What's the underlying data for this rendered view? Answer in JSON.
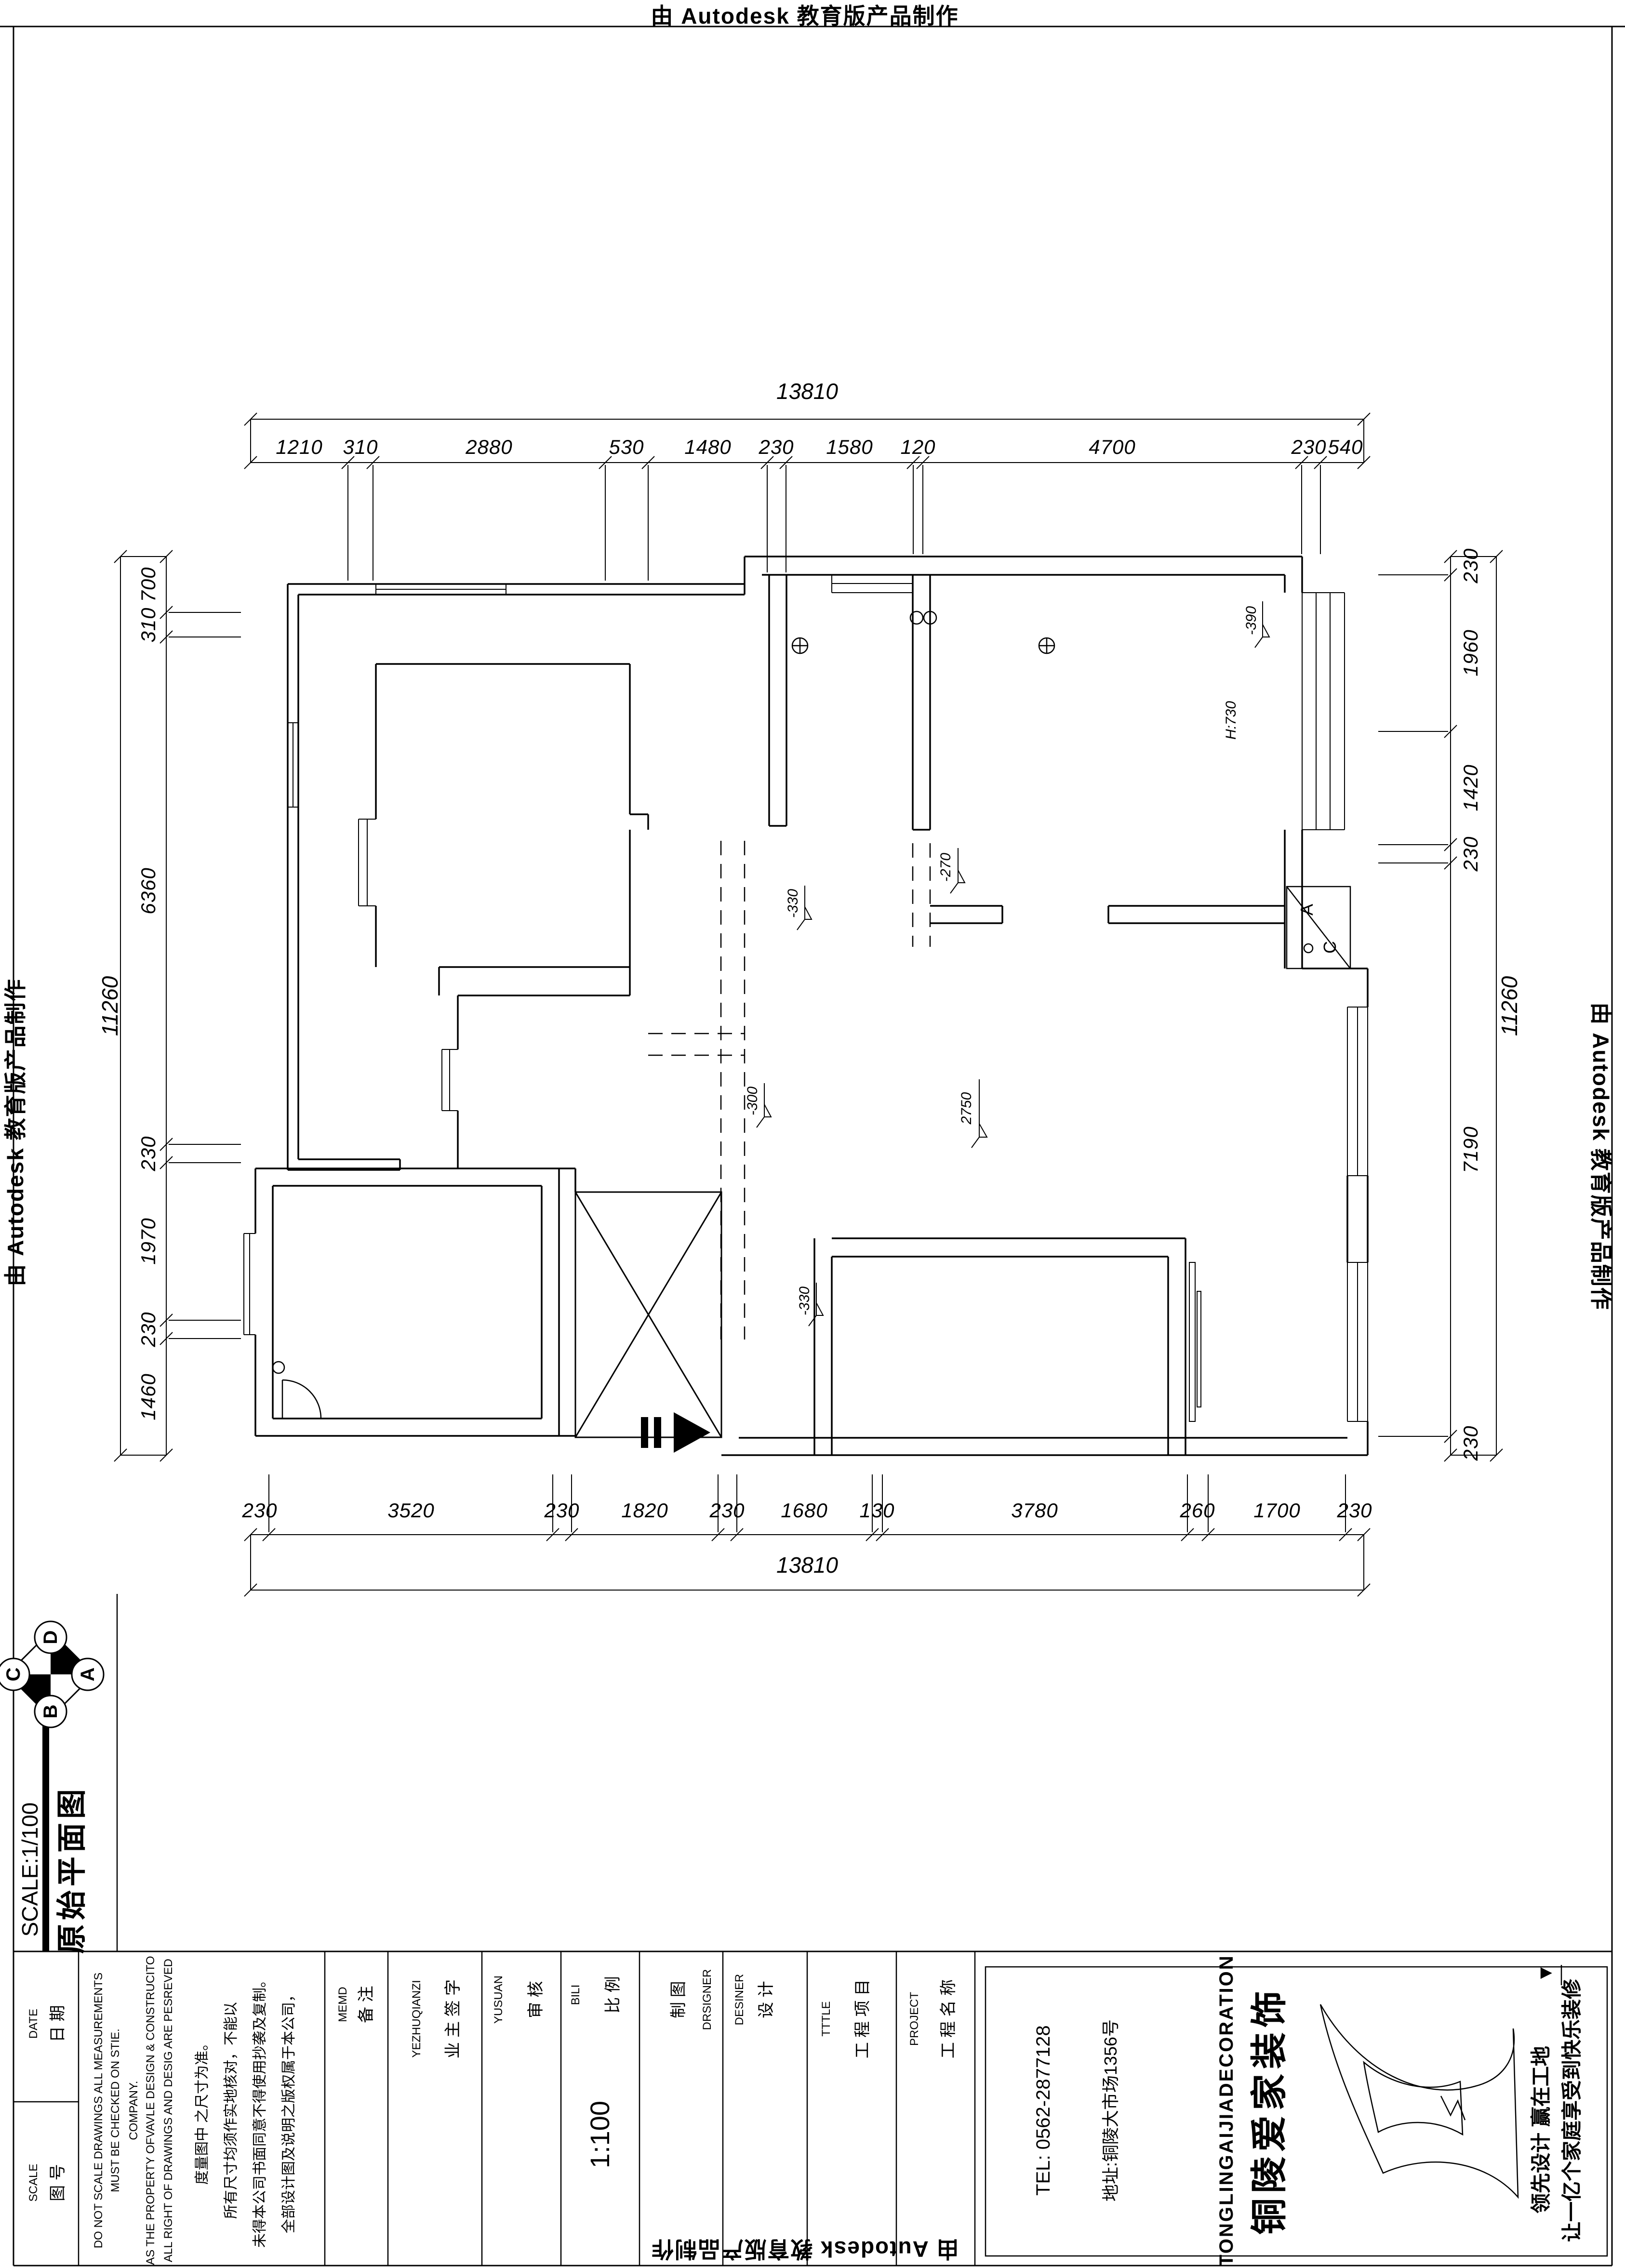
{
  "sheet": {
    "autodesk_credit": "由 Autodesk 教育版产品制作"
  },
  "dimensions": {
    "top": {
      "overall": "13810",
      "segments": [
        "1210",
        "310",
        "2880",
        "530",
        "1480",
        "230",
        "1580",
        "120",
        "4700",
        "230",
        "540"
      ]
    },
    "bottom": {
      "overall": "13810",
      "segments": [
        "230",
        "3520",
        "230",
        "1820",
        "230",
        "1680",
        "130",
        "3780",
        "260",
        "1700",
        "230"
      ]
    },
    "left": {
      "overall": "11260",
      "segments": [
        "700",
        "310",
        "6360",
        "230",
        "1970",
        "230",
        "1460"
      ]
    },
    "right": {
      "overall": "11260",
      "segments": [
        "230",
        "1960",
        "1420",
        "230",
        "7190",
        "230"
      ]
    }
  },
  "levels": {
    "lv390": "-390",
    "h730": "H:730",
    "lv270": "-270",
    "lv330a": "-330",
    "lv300": "-300",
    "lv2750": "2750",
    "lv330b": "-330"
  },
  "ac": {
    "a": "A",
    "c": "C"
  },
  "compass": {
    "n": "D",
    "e": "A",
    "s": "B",
    "w": "C"
  },
  "title": {
    "name": "原始平面图",
    "scale": "SCALE:1/100"
  },
  "titleblock": {
    "date_cn": "日 期",
    "date_en": "DATE",
    "sheet_cn": "图 号",
    "sheet_en": "SCALE",
    "disclaimer_cn": [
      "全部设计图及说明之版权属于本公司，",
      "未得本公司书面同意不得使用抄袭及复制。",
      "所有尺寸均须作实地核对，不能以",
      "度量图中 之尺寸为准。"
    ],
    "disclaimer_en": [
      "ALL RIGHT OF DRAWINGS AND DESIG ARE PESREVED",
      "AS THE PROPERTY OFVAVLE DESIGN & CONSTRUCITO",
      "COMPANY.",
      "DO NOT SCALE DRAWINGS ALL MEASUREMENTS",
      "MUST BE CHECKED ON STIE."
    ],
    "memo_cn": "备 注",
    "memo_en": "MEMD",
    "owner_cn": "业 主 签 字",
    "owner_en": "YEZHUQIANZI",
    "audit_cn": "审 核",
    "audit_en": "YUSUAN",
    "ratio_cn": "比 例",
    "ratio_en": "BILI",
    "ratio_value": "1:100",
    "draft_cn": "制 图",
    "draft_en": "DRSIGNER",
    "design_cn": "设 计",
    "design_en": "DESINER",
    "item_cn": "工 程 项 目",
    "item_en": "TTTLE",
    "project_cn": "工 程 名 称",
    "project_en": "PROJECT",
    "company": {
      "tel": "TEL:  0562-2877128",
      "address": "地址:铜陵大市场1356号",
      "name_en": "TONGLINGAIJIADECORATION",
      "name_cn": "铜陵爱家装饰",
      "slogan1": "让一亿个家庭享受到快乐装修",
      "slogan2": "领先设计   赢在工地"
    }
  }
}
